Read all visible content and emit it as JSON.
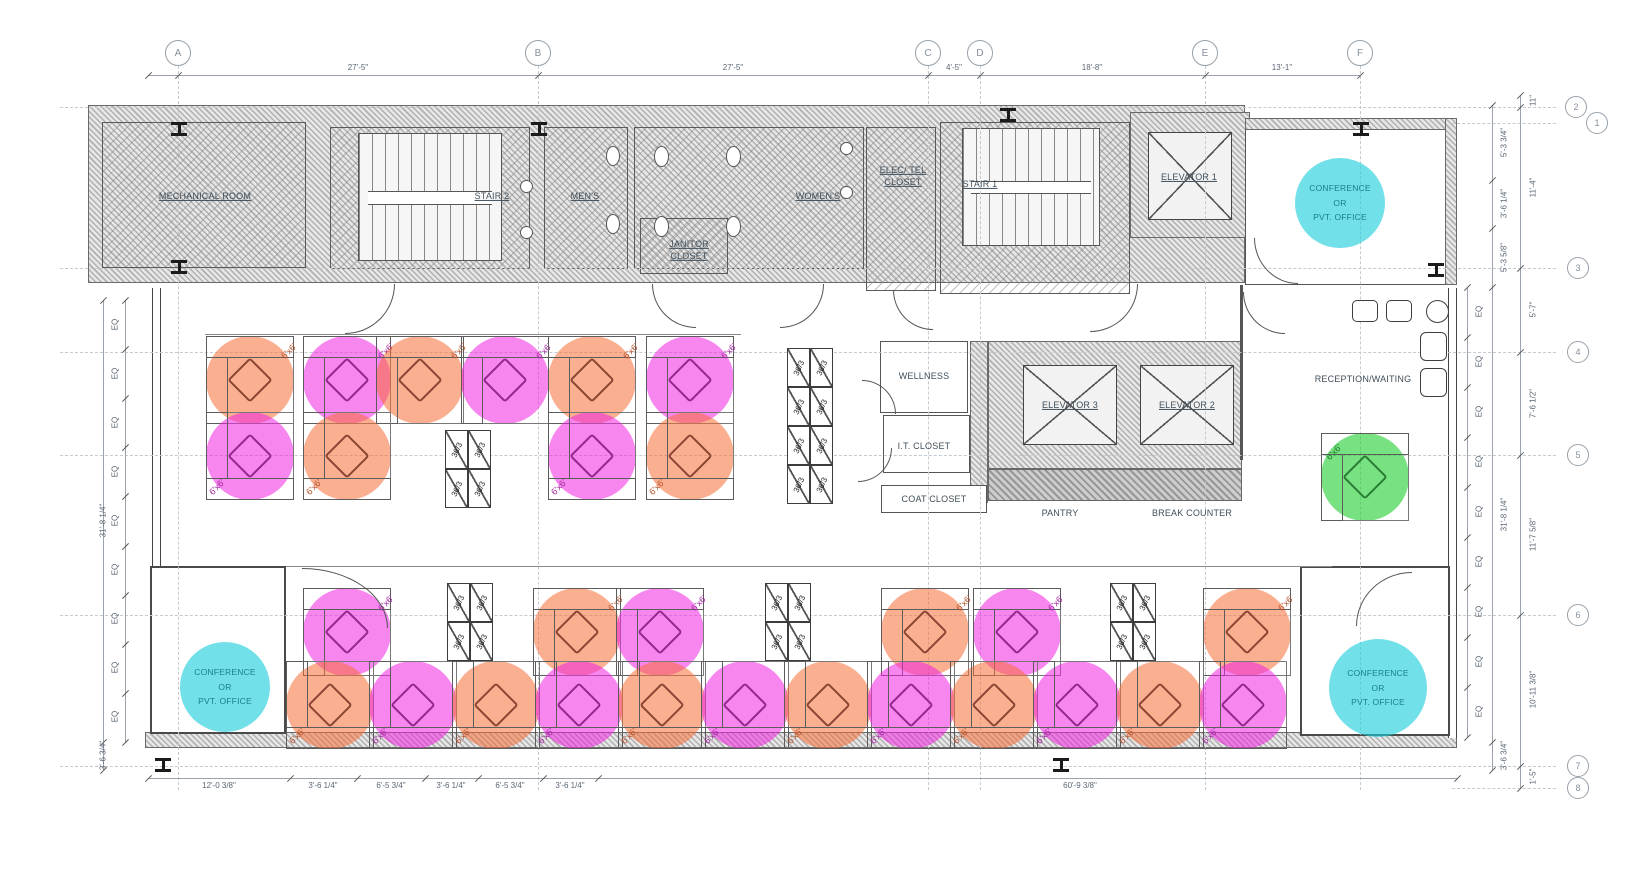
{
  "colors": {
    "orange": "rgba(246,110,52,0.55)",
    "magenta": "rgba(240,35,226,0.55)",
    "green": "rgba(30,205,45,0.60)",
    "cyan": "rgba(28,205,220,0.62)",
    "chair_orange": "#8a4632",
    "chair_magenta": "#93278f",
    "chair_green": "#2a7d32",
    "label_orange": "#b5532e",
    "label_magenta": "#a227a0",
    "label_green": "#1f7d2a"
  },
  "labels": {
    "desk": "6'x6'",
    "cabinet": "36/3",
    "conference": [
      "CONFERENCE",
      "OR",
      "PVT. OFFICE"
    ]
  },
  "rooms": {
    "mechanical": "MECHANICAL ROOM",
    "stair2": "STAIR 2",
    "mens": "MEN'S",
    "janitor": [
      "JANITOR",
      "CLOSET"
    ],
    "womens": "WOMEN'S",
    "electel": [
      "ELEC/ TEL",
      "CLOSET"
    ],
    "stair1": "STAIR 1",
    "elevator1": "ELEVATOR 1",
    "elevator2": "ELEVATOR 2",
    "elevator3": "ELEVATOR 3",
    "wellness": "WELLNESS",
    "it_closet": "I.T. CLOSET",
    "coat_closet": "COAT CLOSET",
    "pantry": "PANTRY",
    "break_counter": "BREAK COUNTER",
    "reception": "RECEPTION/WAITING"
  },
  "grid": {
    "cols": [
      {
        "label": "A",
        "x": 178
      },
      {
        "label": "B",
        "x": 538
      },
      {
        "label": "C",
        "x": 928
      },
      {
        "label": "D",
        "x": 980
      },
      {
        "label": "E",
        "x": 1205
      },
      {
        "label": "F",
        "x": 1360
      }
    ],
    "rows": [
      {
        "label": "2",
        "y": 107,
        "bx": 1576,
        "x1": 60
      },
      {
        "label": "1",
        "y": 123,
        "bx": 1597,
        "x1": 1452
      },
      {
        "label": "3",
        "y": 268,
        "bx": 1578,
        "x1": 60
      },
      {
        "label": "4",
        "y": 352,
        "bx": 1578,
        "x1": 60
      },
      {
        "label": "5",
        "y": 455,
        "bx": 1578,
        "x1": 60
      },
      {
        "label": "6",
        "y": 615,
        "bx": 1578,
        "x1": 60
      },
      {
        "label": "7",
        "y": 766,
        "bx": 1578,
        "x1": 60
      },
      {
        "label": "8",
        "y": 788,
        "bx": 1578,
        "x1": 1452
      }
    ]
  },
  "dimensions": {
    "top": {
      "y": 75,
      "x1": 148,
      "x2": 1360,
      "ticks": [
        148,
        178,
        538,
        928,
        980,
        1205,
        1360
      ],
      "labels": [
        {
          "text": "27'-5\"",
          "x": 358
        },
        {
          "text": "27'-5\"",
          "x": 733
        },
        {
          "text": "4'-5\"",
          "x": 954
        },
        {
          "text": "18'-8\"",
          "x": 1092
        },
        {
          "text": "13'-1\"",
          "x": 1282
        }
      ]
    },
    "bottom": {
      "y": 778,
      "x1": 148,
      "x2": 1457,
      "ticks": [
        148,
        290,
        357,
        425,
        478,
        543,
        598,
        1457
      ],
      "labels": [
        {
          "text": "12'-0 3/8\"",
          "x": 219
        },
        {
          "text": "3'-6 1/4\"",
          "x": 323
        },
        {
          "text": "6'-5 3/4\"",
          "x": 391
        },
        {
          "text": "3'-6 1/4\"",
          "x": 451
        },
        {
          "text": "6'-5 3/4\"",
          "x": 510
        },
        {
          "text": "3'-6 1/4\"",
          "x": 570
        },
        {
          "text": "60'-9 3/8\"",
          "x": 1080
        }
      ]
    },
    "left_eq": {
      "x": 125,
      "lx": 115,
      "y1": 300,
      "y2": 742,
      "count": 9,
      "text": "EQ"
    },
    "left_overall": {
      "x": 103,
      "y1": 300,
      "y2": 770,
      "ticks": [
        300,
        742,
        770
      ],
      "labels": [
        {
          "text": "31'-8 1/4\"",
          "y": 521
        },
        {
          "text": "3'-6 3/4\"",
          "y": 756
        }
      ]
    },
    "right_eq": {
      "x": 1467,
      "lx": 1479,
      "y1": 287,
      "y2": 737,
      "count": 9,
      "text": "EQ"
    },
    "right_mid": {
      "x": 1492,
      "lx": 1504,
      "y1": 105,
      "y2": 770,
      "ticks": [
        105,
        180,
        228,
        287,
        742,
        770
      ],
      "labels": [
        {
          "text": "5'-3 3/4\"",
          "y": 143
        },
        {
          "text": "3'-6 1/4\"",
          "y": 204
        },
        {
          "text": "5'-3 5/8\"",
          "y": 258
        },
        {
          "text": "31'-8 1/4\"",
          "y": 515
        },
        {
          "text": "3'-6 3/4\"",
          "y": 756
        }
      ]
    },
    "right_outer": {
      "x": 1520,
      "lx": 1533,
      "y1": 95,
      "y2": 788,
      "ticks": [
        95,
        107,
        268,
        352,
        455,
        615,
        766,
        788
      ],
      "labels": [
        {
          "text": "11\"",
          "y": 101
        },
        {
          "text": "11'-4\"",
          "y": 188
        },
        {
          "text": "5'-7\"",
          "y": 310
        },
        {
          "text": "7'-6 1/2\"",
          "y": 404
        },
        {
          "text": "11'-7 5/8\"",
          "y": 535
        },
        {
          "text": "10'-11 3/8\"",
          "y": 690
        },
        {
          "text": "1'-5\"",
          "y": 777
        }
      ]
    }
  },
  "desks": [
    {
      "x": 206,
      "y": 336,
      "c": "orange",
      "p": "tr"
    },
    {
      "x": 303,
      "y": 336,
      "c": "magenta",
      "p": "tr"
    },
    {
      "x": 376,
      "y": 336,
      "c": "orange",
      "p": "tr"
    },
    {
      "x": 461,
      "y": 336,
      "c": "magenta",
      "p": "tr"
    },
    {
      "x": 548,
      "y": 336,
      "c": "orange",
      "p": "tr"
    },
    {
      "x": 646,
      "y": 336,
      "c": "magenta",
      "p": "tr"
    },
    {
      "x": 206,
      "y": 412,
      "c": "magenta",
      "p": "bl"
    },
    {
      "x": 303,
      "y": 412,
      "c": "orange",
      "p": "bl"
    },
    {
      "x": 548,
      "y": 412,
      "c": "magenta",
      "p": "bl"
    },
    {
      "x": 646,
      "y": 412,
      "c": "orange",
      "p": "bl"
    },
    {
      "x": 303,
      "y": 588,
      "c": "magenta",
      "p": "tr"
    },
    {
      "x": 533,
      "y": 588,
      "c": "orange",
      "p": "tr"
    },
    {
      "x": 616,
      "y": 588,
      "c": "magenta",
      "p": "tr"
    },
    {
      "x": 881,
      "y": 588,
      "c": "orange",
      "p": "tr"
    },
    {
      "x": 973,
      "y": 588,
      "c": "magenta",
      "p": "tr"
    },
    {
      "x": 1203,
      "y": 588,
      "c": "orange",
      "p": "tr"
    },
    {
      "x": 286,
      "y": 661,
      "c": "orange",
      "p": "bl"
    },
    {
      "x": 369,
      "y": 661,
      "c": "magenta",
      "p": "bl"
    },
    {
      "x": 452,
      "y": 661,
      "c": "orange",
      "p": "bl"
    },
    {
      "x": 535,
      "y": 661,
      "c": "magenta",
      "p": "bl"
    },
    {
      "x": 618,
      "y": 661,
      "c": "orange",
      "p": "bl"
    },
    {
      "x": 701,
      "y": 661,
      "c": "magenta",
      "p": "bl"
    },
    {
      "x": 784,
      "y": 661,
      "c": "orange",
      "p": "bl"
    },
    {
      "x": 867,
      "y": 661,
      "c": "magenta",
      "p": "bl"
    },
    {
      "x": 950,
      "y": 661,
      "c": "orange",
      "p": "bl"
    },
    {
      "x": 1033,
      "y": 661,
      "c": "magenta",
      "p": "bl"
    },
    {
      "x": 1116,
      "y": 661,
      "c": "orange",
      "p": "bl"
    },
    {
      "x": 1199,
      "y": 661,
      "c": "magenta",
      "p": "bl"
    },
    {
      "x": 1321,
      "y": 433,
      "c": "green",
      "p": "tl"
    }
  ],
  "cabinet_groups": [
    {
      "x": 445,
      "y": 430,
      "cols": 2,
      "rows": 2
    },
    {
      "x": 787,
      "y": 348,
      "cols": 2,
      "rows": 4
    },
    {
      "x": 447,
      "y": 583,
      "cols": 2,
      "rows": 2
    },
    {
      "x": 765,
      "y": 583,
      "cols": 2,
      "rows": 2
    },
    {
      "x": 1110,
      "y": 583,
      "cols": 2,
      "rows": 2
    }
  ],
  "conference_circles": [
    {
      "cx": 1340,
      "cy": 203,
      "r": 45
    },
    {
      "cx": 225,
      "cy": 687,
      "r": 45
    },
    {
      "cx": 1378,
      "cy": 688,
      "r": 49
    }
  ],
  "ibeams": [
    {
      "x": 171,
      "y": 122
    },
    {
      "x": 531,
      "y": 122
    },
    {
      "x": 1000,
      "y": 108
    },
    {
      "x": 1353,
      "y": 122
    },
    {
      "x": 171,
      "y": 260
    },
    {
      "x": 1428,
      "y": 263
    },
    {
      "x": 155,
      "y": 758
    },
    {
      "x": 1053,
      "y": 758
    }
  ],
  "doors": [
    {
      "x": 345,
      "y": 284,
      "w": 50,
      "h": 50,
      "c": "br"
    },
    {
      "x": 652,
      "y": 284,
      "w": 44,
      "h": 44,
      "c": "bl"
    },
    {
      "x": 780,
      "y": 284,
      "w": 44,
      "h": 44,
      "c": "br"
    },
    {
      "x": 893,
      "y": 290,
      "w": 40,
      "h": 40,
      "c": "bl"
    },
    {
      "x": 1090,
      "y": 284,
      "w": 48,
      "h": 48,
      "c": "br"
    },
    {
      "x": 1254,
      "y": 238,
      "w": 44,
      "h": 46,
      "c": "bl"
    },
    {
      "x": 862,
      "y": 380,
      "w": 34,
      "h": 34,
      "c": "tr"
    },
    {
      "x": 858,
      "y": 448,
      "w": 34,
      "h": 34,
      "c": "br"
    },
    {
      "x": 302,
      "y": 568,
      "w": 86,
      "h": 60,
      "c": "tr"
    },
    {
      "x": 1356,
      "y": 572,
      "w": 56,
      "h": 54,
      "c": "tl"
    },
    {
      "x": 1243,
      "y": 292,
      "w": 42,
      "h": 42,
      "c": "bl"
    }
  ]
}
